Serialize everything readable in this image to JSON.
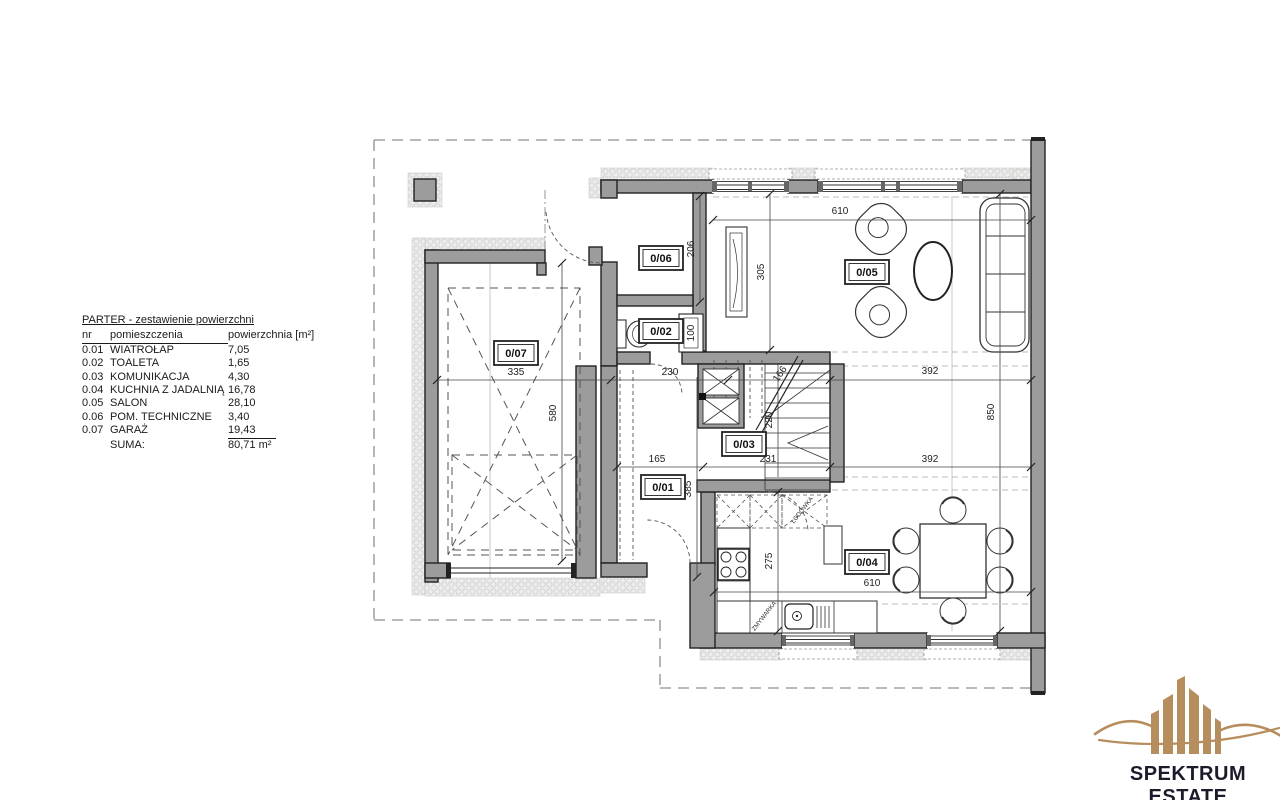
{
  "table": {
    "title": "PARTER - zestawienie powierzchni",
    "col_nr": "nr",
    "col_name": "pomieszczenia",
    "col_area": "powierzchnia [m²]",
    "rows": [
      {
        "nr": "0.01",
        "name": "WIATROŁAP",
        "area": "7,05"
      },
      {
        "nr": "0.02",
        "name": "TOALETA",
        "area": "1,65"
      },
      {
        "nr": "0.03",
        "name": "KOMUNIKACJA",
        "area": "4,30"
      },
      {
        "nr": "0.04",
        "name": "KUCHNIA Z JADALNIĄ",
        "area": "16,78"
      },
      {
        "nr": "0.05",
        "name": "SALON",
        "area": "28,10"
      },
      {
        "nr": "0.06",
        "name": "POM. TECHNICZNE",
        "area": "3,40"
      },
      {
        "nr": "0.07",
        "name": "GARAŻ",
        "area": "19,43"
      }
    ],
    "suma_label": "SUMA:",
    "suma_value": "80,71 m²"
  },
  "rooms": {
    "r01": "0/01",
    "r02": "0/02",
    "r03": "0/03",
    "r04": "0/04",
    "r05": "0/05",
    "r06": "0/06",
    "r07": "0/07"
  },
  "dims": {
    "top610": "610",
    "bot610": "610",
    "g206": "206",
    "g305": "305",
    "n100": "100",
    "c335": "335",
    "c230": "230",
    "c166": "166",
    "c392a": "392",
    "c392b": "392",
    "m165": "165",
    "m231": "231",
    "v220": "220",
    "v385": "385",
    "v275": "275",
    "v580": "580",
    "v850": "850"
  },
  "annotations": {
    "fridge": "LODÓWKA",
    "dishwasher": "ZMYWARKA"
  },
  "logo": {
    "name": "SPEKTRUM ESTATE",
    "subtitle": "BIURO NIERUCHOMOŚCI"
  },
  "colors": {
    "wall": "#9c9c9c",
    "gold": "#b68d5c",
    "dark": "#1b1b2c"
  }
}
